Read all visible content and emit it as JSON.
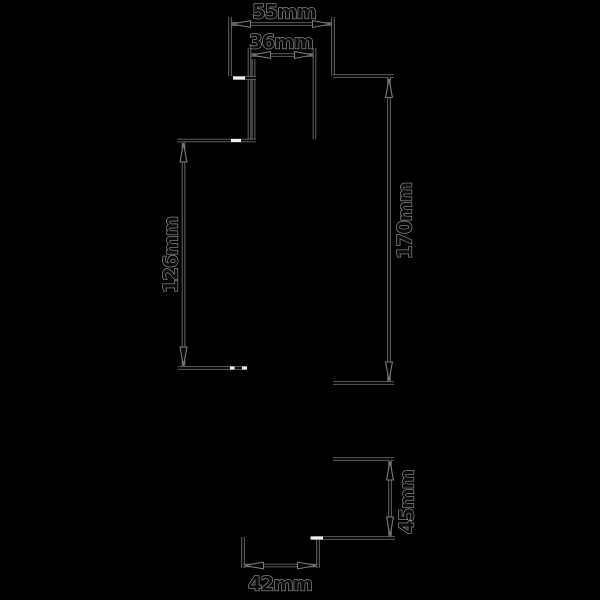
{
  "figure": {
    "type": "technical-dimension-diagram",
    "canvas": {
      "width": 600,
      "height": 600,
      "background": "#000000"
    },
    "style": {
      "line_outer_color": "#6a6a6a",
      "line_core_color": "#000000",
      "line_outer_width": 3.6,
      "line_core_width": 1.7,
      "white_mark_color": "#f0f0f0",
      "white_mark_width": 3.2,
      "arrow_fill": "#050505",
      "arrow_stroke": "#7a7a7a",
      "arrow_length": 19,
      "arrow_half_width": 3.4,
      "text_fill": "#0b0b0b",
      "text_stroke": "#969696",
      "text_stroke_width": 1.25,
      "font_size": 19.5,
      "letter_spacing": -1
    },
    "lines": [
      {
        "name": "dim-line-55mm",
        "x1": 230,
        "y1": 24,
        "x2": 333,
        "y2": 24
      },
      {
        "name": "ext-line-55mm-left",
        "x1": 230,
        "y1": 17,
        "x2": 230,
        "y2": 76
      },
      {
        "name": "ext-line-55mm-right",
        "x1": 333,
        "y1": 17,
        "x2": 333,
        "y2": 76
      },
      {
        "name": "dim-line-36mm",
        "x1": 250,
        "y1": 55,
        "x2": 315,
        "y2": 55
      },
      {
        "name": "ext-line-36mm-left",
        "x1": 249.5,
        "y1": 48,
        "x2": 249.5,
        "y2": 140
      },
      {
        "name": "edge-neck-left",
        "x1": 253.5,
        "y1": 59,
        "x2": 253.5,
        "y2": 140
      },
      {
        "name": "ext-line-36mm-right",
        "x1": 314.5,
        "y1": 48,
        "x2": 314.5,
        "y2": 139
      },
      {
        "name": "edge-top-left-step",
        "x1": 233,
        "y1": 78,
        "x2": 256,
        "y2": 78
      },
      {
        "name": "edge-left-shoulder",
        "x1": 177,
        "y1": 140.5,
        "x2": 256,
        "y2": 140.5
      },
      {
        "name": "dim-line-126mm",
        "x1": 183.5,
        "y1": 142,
        "x2": 183.5,
        "y2": 367
      },
      {
        "name": "edge-left-bottom-shoulder",
        "x1": 178,
        "y1": 368,
        "x2": 246,
        "y2": 368
      },
      {
        "name": "ext-line-170mm-top",
        "x1": 333,
        "y1": 76,
        "x2": 394,
        "y2": 76
      },
      {
        "name": "dim-line-170mm",
        "x1": 389,
        "y1": 77,
        "x2": 389,
        "y2": 382
      },
      {
        "name": "ext-line-170mm-bottom",
        "x1": 333,
        "y1": 383,
        "x2": 394,
        "y2": 383
      },
      {
        "name": "ext-line-45mm-top",
        "x1": 333,
        "y1": 459,
        "x2": 394,
        "y2": 459
      },
      {
        "name": "dim-line-45mm",
        "x1": 390,
        "y1": 460,
        "x2": 390,
        "y2": 537
      },
      {
        "name": "ext-line-45mm-bottom",
        "x1": 313,
        "y1": 538,
        "x2": 395,
        "y2": 538
      },
      {
        "name": "ext-line-42mm-left",
        "x1": 243,
        "y1": 537,
        "x2": 243,
        "y2": 568
      },
      {
        "name": "ext-line-42mm-right",
        "x1": 318,
        "y1": 539,
        "x2": 318,
        "y2": 568
      },
      {
        "name": "dim-line-42mm",
        "x1": 243,
        "y1": 565.5,
        "x2": 318,
        "y2": 565.5
      }
    ],
    "white_marks": [
      {
        "name": "white-break-top-left",
        "x1": 233,
        "y1": 78,
        "x2": 245,
        "y2": 78
      },
      {
        "name": "white-break-left-shoulder",
        "x1": 231,
        "y1": 140.5,
        "x2": 241,
        "y2": 140.5
      },
      {
        "name": "white-break-bottom-shoulder-a",
        "x1": 230,
        "y1": 368,
        "x2": 234.5,
        "y2": 368
      },
      {
        "name": "white-break-bottom-shoulder-b",
        "x1": 242,
        "y1": 368,
        "x2": 247,
        "y2": 368
      },
      {
        "name": "white-break-45mm-bottom",
        "x1": 310.5,
        "y1": 538,
        "x2": 323,
        "y2": 538
      }
    ],
    "arrows": [
      {
        "name": "arrow-55mm-left",
        "x": 231.5,
        "y": 24,
        "dir": "left"
      },
      {
        "name": "arrow-55mm-right",
        "x": 331.5,
        "y": 24,
        "dir": "right"
      },
      {
        "name": "arrow-36mm-left",
        "x": 251.5,
        "y": 55,
        "dir": "left"
      },
      {
        "name": "arrow-36mm-right",
        "x": 313.5,
        "y": 55,
        "dir": "right"
      },
      {
        "name": "arrow-126mm-top",
        "x": 183.5,
        "y": 143,
        "dir": "up"
      },
      {
        "name": "arrow-126mm-bottom",
        "x": 183.5,
        "y": 366,
        "dir": "down"
      },
      {
        "name": "arrow-170mm-top",
        "x": 389,
        "y": 78.5,
        "dir": "up"
      },
      {
        "name": "arrow-170mm-bottom",
        "x": 389,
        "y": 381,
        "dir": "down"
      },
      {
        "name": "arrow-45mm-top",
        "x": 390,
        "y": 461,
        "dir": "up"
      },
      {
        "name": "arrow-45mm-bottom",
        "x": 390,
        "y": 536,
        "dir": "down"
      },
      {
        "name": "arrow-42mm-left",
        "x": 244.5,
        "y": 565.5,
        "dir": "left"
      },
      {
        "name": "arrow-42mm-right",
        "x": 316.5,
        "y": 565.5,
        "dir": "right"
      }
    ],
    "labels": [
      {
        "name": "dim-label-55mm",
        "text": "55mm",
        "x": 284,
        "y": 12,
        "rotate": 0
      },
      {
        "name": "dim-label-36mm",
        "text": "36mm",
        "x": 281,
        "y": 42,
        "rotate": 0
      },
      {
        "name": "dim-label-170mm",
        "text": "170mm",
        "x": 405,
        "y": 221,
        "rotate": -90
      },
      {
        "name": "dim-label-126mm",
        "text": "126mm",
        "x": 171,
        "y": 255,
        "rotate": -90
      },
      {
        "name": "dim-label-45mm",
        "text": "45mm",
        "x": 407,
        "y": 502,
        "rotate": -90
      },
      {
        "name": "dim-label-42mm",
        "text": "42mm",
        "x": 280,
        "y": 584,
        "rotate": 0
      }
    ]
  }
}
